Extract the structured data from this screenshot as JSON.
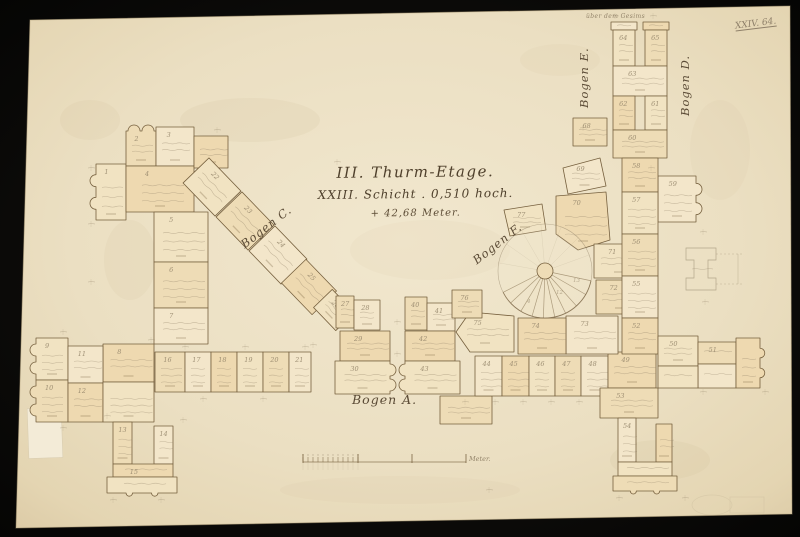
{
  "frame": {
    "paper_color": "#ece1c6",
    "border_color": "#0d0c0a",
    "ink": "#76603e",
    "pencil": "#97886d",
    "fill_palette": [
      "#f1e3c2",
      "#eedcb6",
      "#f3e6ca",
      "#eed9b0"
    ]
  },
  "corner_mark": "XXIV. 64.",
  "title": {
    "line1": "III. Thurm-Etage.",
    "line2": "XXIII. Schicht . 0,510 hoch.",
    "line3": "+ 42,68 Meter."
  },
  "labels": {
    "bogen_a": "Bogen A.",
    "bogen_c": "Bogen C.",
    "bogen_d": "Bogen D.",
    "bogen_e": "Bogen E.",
    "bogen_f": "Bogen F.",
    "top_note": "über dem Gesims",
    "scale_unit": "Meter."
  },
  "plan": {
    "blocks": [
      [
        "m",
        "1",
        96,
        164,
        30,
        56,
        "l"
      ],
      [
        "m",
        "2",
        126,
        131,
        30,
        35,
        "t"
      ],
      [
        "r",
        "3",
        156,
        127,
        38,
        39
      ],
      [
        "r",
        "4",
        126,
        166,
        68,
        46
      ],
      [
        "r",
        "5",
        154,
        212,
        54,
        50
      ],
      [
        "r",
        "6",
        154,
        262,
        54,
        46
      ],
      [
        "r",
        "7",
        154,
        308,
        54,
        36
      ],
      [
        "r",
        "8",
        103,
        344,
        51,
        38
      ],
      [
        "m",
        "9",
        36,
        338,
        32,
        42,
        "l"
      ],
      [
        "m",
        "10",
        36,
        380,
        32,
        42,
        "l"
      ],
      [
        "r",
        "11",
        68,
        346,
        35,
        37
      ],
      [
        "r",
        "12",
        68,
        383,
        35,
        39
      ],
      [
        "r",
        "",
        103,
        382,
        51,
        40
      ],
      [
        "r",
        "13",
        113,
        422,
        19,
        42
      ],
      [
        "r",
        "14",
        154,
        426,
        19,
        38
      ],
      [
        "r",
        "15",
        113,
        464,
        60,
        13
      ],
      [
        "m",
        "",
        107,
        477,
        70,
        16,
        "b"
      ],
      [
        "r",
        "16",
        155,
        352,
        30,
        40
      ],
      [
        "r",
        "17",
        185,
        352,
        26,
        40
      ],
      [
        "r",
        "18",
        211,
        352,
        26,
        40
      ],
      [
        "r",
        "19",
        237,
        352,
        26,
        40
      ],
      [
        "r",
        "20",
        263,
        352,
        26,
        40
      ],
      [
        "r",
        "21",
        289,
        352,
        22,
        40
      ],
      [
        "r",
        "",
        194,
        136,
        34,
        32
      ],
      [
        "d",
        "22",
        212,
        187,
        46,
        36,
        46
      ],
      [
        "d",
        "23",
        245,
        221,
        46,
        36,
        46
      ],
      [
        "d",
        "24",
        278,
        255,
        46,
        36,
        46
      ],
      [
        "d",
        "25",
        309,
        287,
        44,
        34,
        46
      ],
      [
        "d",
        "26",
        334,
        310,
        32,
        26,
        46
      ],
      [
        "r",
        "27",
        336,
        296,
        18,
        32
      ],
      [
        "r",
        "28",
        354,
        300,
        26,
        30
      ],
      [
        "r",
        "29",
        340,
        331,
        50,
        30
      ],
      [
        "m",
        "30",
        335,
        361,
        55,
        33,
        "r"
      ],
      [
        "r",
        "40",
        405,
        297,
        22,
        33
      ],
      [
        "r",
        "41",
        427,
        303,
        28,
        28
      ],
      [
        "r",
        "42",
        405,
        331,
        50,
        30
      ],
      [
        "m",
        "43",
        405,
        361,
        55,
        33,
        "l"
      ],
      [
        "r",
        "",
        440,
        396,
        52,
        28
      ],
      [
        "r",
        "44",
        475,
        356,
        27,
        40
      ],
      [
        "r",
        "45",
        502,
        356,
        27,
        40
      ],
      [
        "r",
        "46",
        529,
        356,
        26,
        40
      ],
      [
        "r",
        "47",
        555,
        356,
        26,
        40
      ],
      [
        "r",
        "48",
        581,
        356,
        27,
        40
      ],
      [
        "r",
        "49",
        608,
        352,
        48,
        36
      ],
      [
        "p",
        "77",
        [
          [
            504,
            210
          ],
          [
            542,
            204
          ],
          [
            546,
            230
          ],
          [
            510,
            236
          ]
        ]
      ],
      [
        "r",
        "68",
        573,
        118,
        34,
        28
      ],
      [
        "p",
        "69",
        [
          [
            563,
            168
          ],
          [
            600,
            158
          ],
          [
            606,
            186
          ],
          [
            568,
            194
          ]
        ]
      ],
      [
        "p",
        "70",
        [
          [
            556,
            196
          ],
          [
            606,
            192
          ],
          [
            610,
            240
          ],
          [
            578,
            250
          ],
          [
            556,
            234
          ]
        ]
      ],
      [
        "r",
        "71",
        594,
        244,
        50,
        34
      ],
      [
        "r",
        "72",
        596,
        280,
        48,
        34
      ],
      [
        "r",
        "73",
        566,
        316,
        52,
        38
      ],
      [
        "r",
        "74",
        518,
        318,
        48,
        36
      ],
      [
        "p",
        "75",
        [
          [
            470,
            312
          ],
          [
            514,
            316
          ],
          [
            514,
            352
          ],
          [
            470,
            352
          ],
          [
            456,
            332
          ]
        ]
      ],
      [
        "r",
        "76",
        452,
        290,
        30,
        28
      ],
      [
        "r",
        "",
        611,
        22,
        26,
        8
      ],
      [
        "r",
        "",
        643,
        22,
        26,
        8
      ],
      [
        "r",
        "64",
        613,
        30,
        22,
        36
      ],
      [
        "r",
        "65",
        645,
        30,
        22,
        36
      ],
      [
        "r",
        "63",
        613,
        66,
        54,
        30
      ],
      [
        "r",
        "62",
        613,
        96,
        22,
        34
      ],
      [
        "r",
        "61",
        645,
        96,
        22,
        34
      ],
      [
        "r",
        "60",
        613,
        130,
        54,
        28
      ],
      [
        "m",
        "59",
        658,
        176,
        38,
        46,
        "r"
      ],
      [
        "r",
        "58",
        622,
        158,
        36,
        34
      ],
      [
        "r",
        "57",
        622,
        192,
        36,
        42
      ],
      [
        "r",
        "56",
        622,
        234,
        36,
        42
      ],
      [
        "r",
        "55",
        622,
        276,
        36,
        42
      ],
      [
        "r",
        "52",
        622,
        318,
        36,
        36
      ],
      [
        "r",
        "50",
        658,
        336,
        40,
        30
      ],
      [
        "r",
        "51",
        698,
        342,
        38,
        22
      ],
      [
        "r",
        "",
        698,
        364,
        38,
        24
      ],
      [
        "m",
        "",
        736,
        338,
        24,
        50,
        "r"
      ],
      [
        "r",
        "",
        658,
        366,
        40,
        22
      ],
      [
        "r",
        "53",
        600,
        388,
        58,
        30
      ],
      [
        "r",
        "54",
        618,
        418,
        18,
        44
      ],
      [
        "r",
        "",
        656,
        424,
        16,
        38
      ],
      [
        "r",
        "",
        618,
        462,
        54,
        14
      ],
      [
        "m",
        "",
        613,
        476,
        64,
        15,
        "b"
      ]
    ],
    "spiral": {
      "cx": 545,
      "cy": 271,
      "r": 47,
      "newel_r": 8,
      "step_angles": [
        12,
        30,
        48,
        64,
        78,
        92,
        106,
        121,
        137,
        153
      ],
      "faint_angles": [
        -20,
        -45,
        -70,
        -95,
        -120,
        -145,
        -170
      ],
      "step_marks": [
        {
          "t": "4",
          "x": 527,
          "y": 303
        },
        {
          "t": "12",
          "x": 556,
          "y": 294
        },
        {
          "t": "13",
          "x": 573,
          "y": 282
        }
      ]
    },
    "scalebar": {
      "x1": 303,
      "x2": 466,
      "y": 462,
      "sub_x2": 358,
      "subs": 12,
      "mid_x": 412
    },
    "detail": {
      "x": 686,
      "y": 248
    },
    "dims": [
      [
        88,
        168
      ],
      [
        88,
        224
      ],
      [
        88,
        282
      ],
      [
        148,
        340
      ],
      [
        60,
        332
      ],
      [
        60,
        428
      ],
      [
        104,
        416
      ],
      [
        180,
        420
      ],
      [
        110,
        500
      ],
      [
        158,
        500
      ],
      [
        182,
        347
      ],
      [
        242,
        347
      ],
      [
        302,
        347
      ],
      [
        394,
        322
      ],
      [
        394,
        354
      ],
      [
        462,
        402
      ],
      [
        492,
        402
      ],
      [
        520,
        402
      ],
      [
        548,
        402
      ],
      [
        576,
        402
      ],
      [
        648,
        168
      ],
      [
        700,
        232
      ],
      [
        702,
        302
      ],
      [
        700,
        392
      ],
      [
        762,
        392
      ],
      [
        616,
        498
      ],
      [
        682,
        498
      ],
      [
        612,
        16
      ],
      [
        650,
        16
      ],
      [
        580,
        128
      ],
      [
        334,
        162
      ],
      [
        486,
        490
      ],
      [
        214,
        130
      ],
      [
        310,
        345
      ],
      [
        200,
        399
      ],
      [
        260,
        399
      ]
    ]
  }
}
